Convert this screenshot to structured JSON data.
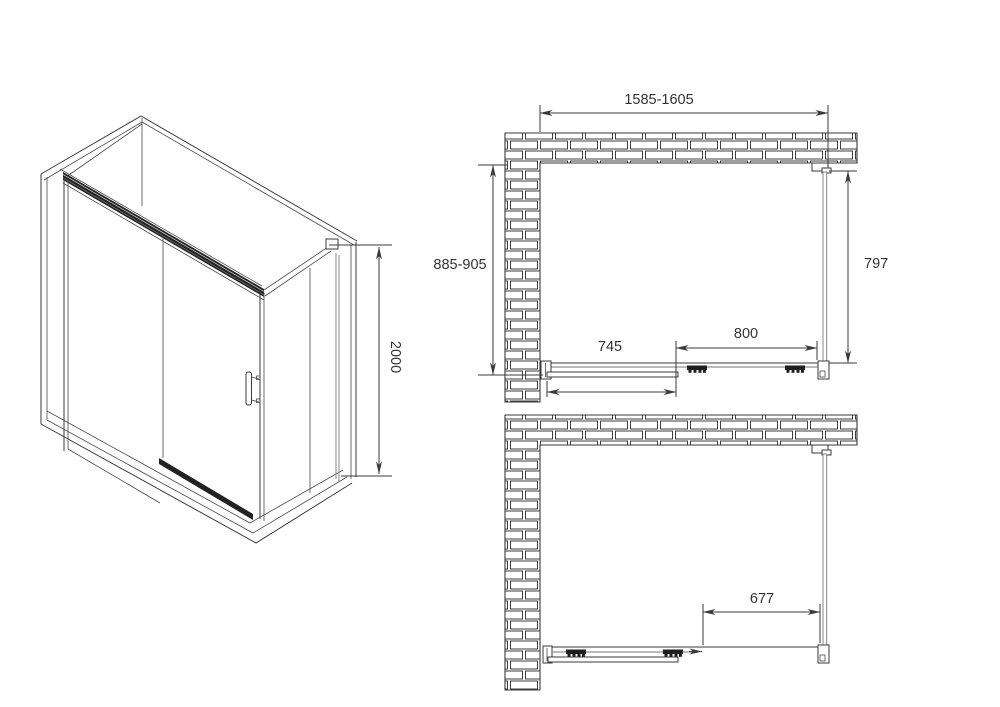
{
  "drawing": {
    "kind": "shower-enclosure-technical-drawing",
    "colors": {
      "background": "#ffffff",
      "line": "#3a3a3a",
      "glass": "#949494",
      "rail_dark": "#1f1f1f",
      "text": "#333333"
    },
    "views": {
      "isometric": {
        "dimensions": {
          "height": "2000"
        }
      },
      "plan_closed": {
        "dimensions": {
          "overall_width": "1585-1605",
          "depth": "885-905",
          "side_panel": "797",
          "fixed_section": "745",
          "sliding_door": "800"
        }
      },
      "plan_open": {
        "dimensions": {
          "opening": "677"
        }
      }
    }
  }
}
